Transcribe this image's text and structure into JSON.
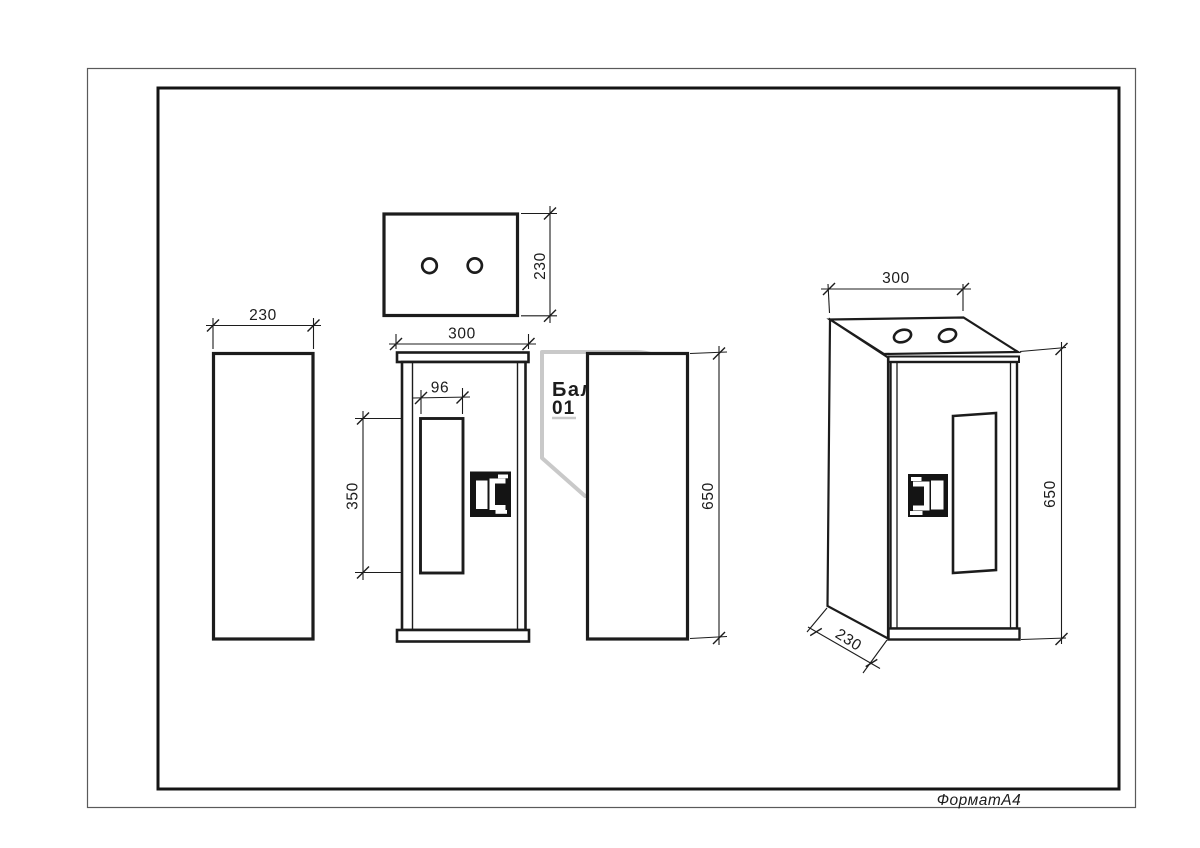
{
  "sheet": {
    "format_label": "ФорматА4"
  },
  "watermark": {
    "brand": "Балтика",
    "number": "01",
    "color": "#c9c9c9"
  },
  "colors": {
    "line": "#1c1c1c",
    "background": "#ffffff"
  },
  "views": {
    "top": {
      "title": "top view",
      "dim_depth": "230"
    },
    "left": {
      "title": "left side view",
      "dim_width": "230"
    },
    "front": {
      "title": "front view",
      "dim_width": "300",
      "dim_window_width": "96",
      "dim_window_height": "350"
    },
    "right": {
      "title": "right side view",
      "dim_height": "650"
    },
    "iso": {
      "title": "perspective view",
      "dim_width": "300",
      "dim_height": "650",
      "dim_depth": "230"
    }
  }
}
